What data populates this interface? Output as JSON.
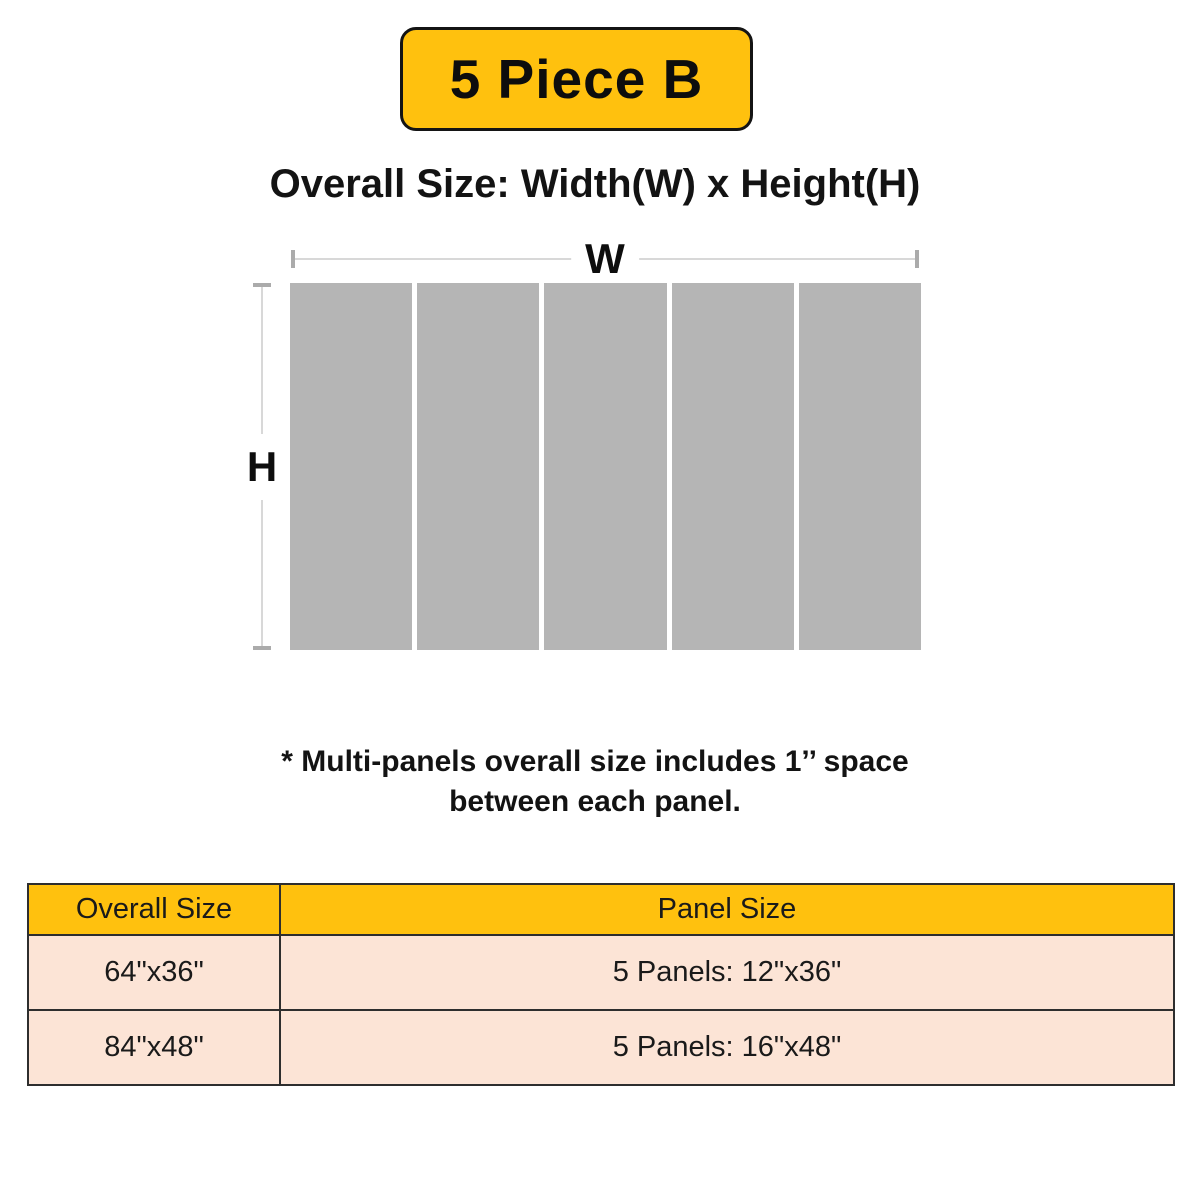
{
  "badge": {
    "label": "5 Piece B"
  },
  "heading": "Overall Size: Width(W) x Height(H)",
  "diagram": {
    "width_label": "W",
    "height_label": "H",
    "panel_count": 5
  },
  "note": {
    "line1": "* Multi-panels overall size includes 1’’ space",
    "line2": "between each panel."
  },
  "table": {
    "headers": [
      "Overall Size",
      "Panel Size"
    ],
    "rows": [
      [
        "64\"x36\"",
        "5 Panels: 12\"x36\""
      ],
      [
        "84\"x48\"",
        "5 Panels: 16\"x48\""
      ]
    ]
  },
  "colors": {
    "accent_yellow": "#FFC10E",
    "row_pink": "#FCE4D6",
    "panel_gray": "#B5B5B5",
    "dim_line": "#D8D8D8",
    "dim_cap": "#ABABAB",
    "border_dark": "#2E2E2E",
    "text_black": "#141414"
  }
}
